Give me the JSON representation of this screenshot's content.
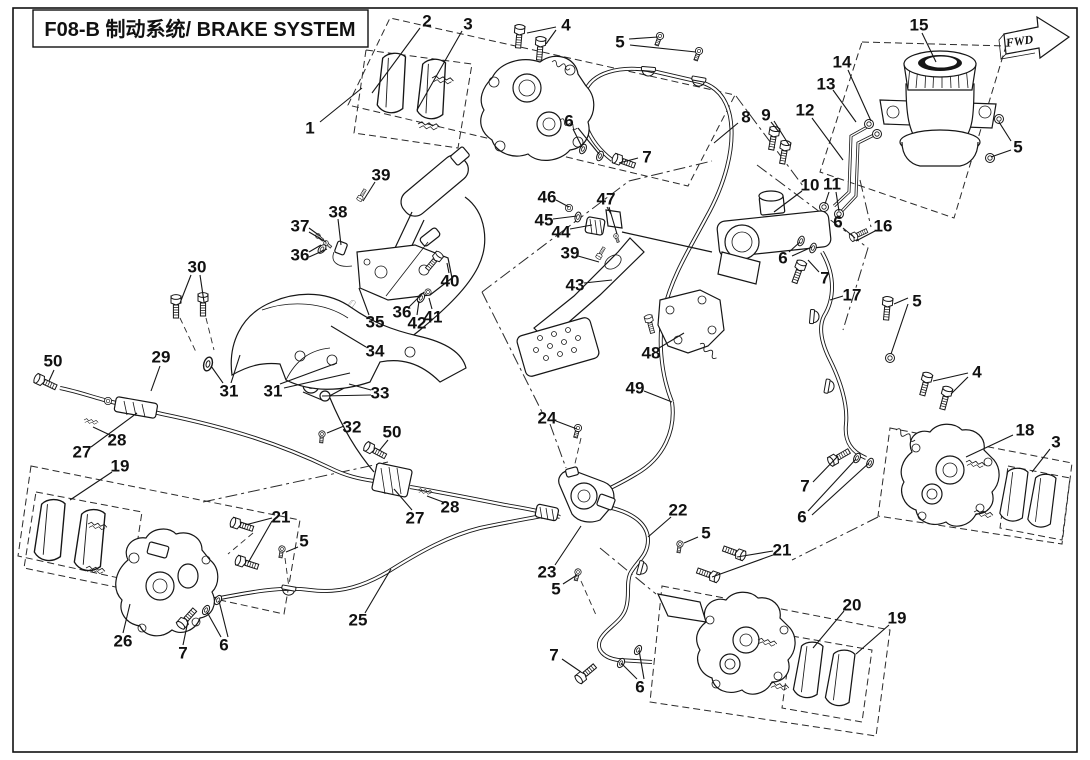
{
  "title": "F08-B 制动系统/ BRAKE SYSTEM",
  "fwd_label": "FWD",
  "callouts": [
    {
      "n": "1",
      "x": 310,
      "y": 128,
      "lines": [
        [
          320,
          122,
          362,
          88
        ]
      ]
    },
    {
      "n": "2",
      "x": 427,
      "y": 21,
      "lines": [
        [
          420,
          28,
          372,
          93
        ]
      ]
    },
    {
      "n": "3",
      "x": 468,
      "y": 24,
      "lines": [
        [
          462,
          31,
          417,
          110
        ]
      ]
    },
    {
      "n": "4",
      "x": 566,
      "y": 25,
      "lines": [
        [
          556,
          27,
          527,
          33
        ],
        [
          556,
          30,
          546,
          44
        ]
      ]
    },
    {
      "n": "5",
      "x": 620,
      "y": 42,
      "lines": [
        [
          629,
          39,
          658,
          37
        ],
        [
          630,
          45,
          696,
          52
        ]
      ]
    },
    {
      "n": "6",
      "x": 569,
      "y": 121,
      "lines": [
        [
          573,
          129,
          582,
          147
        ],
        [
          578,
          128,
          599,
          154
        ]
      ]
    },
    {
      "n": "7",
      "x": 647,
      "y": 157,
      "lines": [
        [
          638,
          158,
          619,
          163
        ]
      ]
    },
    {
      "n": "8",
      "x": 746,
      "y": 117,
      "lines": [
        [
          738,
          123,
          714,
          143
        ]
      ]
    },
    {
      "n": "9",
      "x": 766,
      "y": 115,
      "lines": [
        [
          771,
          122,
          779,
          132
        ],
        [
          774,
          121,
          789,
          145
        ]
      ]
    },
    {
      "n": "12",
      "x": 805,
      "y": 110,
      "lines": [
        [
          812,
          118,
          843,
          160
        ]
      ]
    },
    {
      "n": "13",
      "x": 826,
      "y": 84,
      "lines": [
        [
          833,
          90,
          856,
          122
        ]
      ]
    },
    {
      "n": "14",
      "x": 842,
      "y": 62,
      "lines": [
        [
          848,
          70,
          871,
          121
        ]
      ]
    },
    {
      "n": "15",
      "x": 919,
      "y": 25,
      "lines": [
        [
          922,
          33,
          936,
          62
        ]
      ]
    },
    {
      "n": "5",
      "x": 1018,
      "y": 147,
      "lines": [
        [
          1011,
          141,
          999,
          122
        ],
        [
          1011,
          150,
          991,
          157
        ]
      ]
    },
    {
      "n": "10",
      "x": 810,
      "y": 185,
      "lines": [
        [
          802,
          191,
          774,
          212
        ]
      ]
    },
    {
      "n": "11",
      "x": 832,
      "y": 184,
      "lines": [
        [
          829,
          192,
          825,
          204
        ],
        [
          836,
          192,
          839,
          211
        ]
      ]
    },
    {
      "n": "6",
      "x": 838,
      "y": 222,
      "lines": [
        [
          843,
          228,
          855,
          238
        ]
      ]
    },
    {
      "n": "16",
      "x": 883,
      "y": 226,
      "lines": [
        [
          875,
          231,
          856,
          241
        ]
      ]
    },
    {
      "n": "6",
      "x": 783,
      "y": 258,
      "lines": [
        [
          789,
          252,
          800,
          242
        ],
        [
          792,
          256,
          812,
          247
        ]
      ]
    },
    {
      "n": "7",
      "x": 825,
      "y": 278,
      "lines": [
        [
          819,
          272,
          808,
          260
        ]
      ]
    },
    {
      "n": "17",
      "x": 852,
      "y": 295,
      "lines": [
        [
          843,
          296,
          830,
          300
        ]
      ]
    },
    {
      "n": "5",
      "x": 917,
      "y": 301,
      "lines": [
        [
          908,
          298,
          894,
          304
        ],
        [
          908,
          304,
          891,
          354
        ]
      ]
    },
    {
      "n": "4",
      "x": 977,
      "y": 372,
      "lines": [
        [
          968,
          373,
          933,
          381
        ],
        [
          968,
          377,
          951,
          394
        ]
      ]
    },
    {
      "n": "18",
      "x": 1025,
      "y": 430,
      "lines": [
        [
          1013,
          435,
          966,
          457
        ]
      ]
    },
    {
      "n": "3",
      "x": 1056,
      "y": 442,
      "lines": [
        [
          1050,
          449,
          1032,
          472
        ]
      ]
    },
    {
      "n": "7",
      "x": 805,
      "y": 486,
      "lines": [
        [
          813,
          482,
          838,
          456
        ]
      ]
    },
    {
      "n": "6",
      "x": 802,
      "y": 517,
      "lines": [
        [
          808,
          511,
          856,
          459
        ],
        [
          812,
          515,
          869,
          463
        ]
      ]
    },
    {
      "n": "46",
      "x": 547,
      "y": 197,
      "lines": [
        [
          556,
          200,
          569,
          207
        ]
      ]
    },
    {
      "n": "45",
      "x": 544,
      "y": 220,
      "lines": [
        [
          553,
          219,
          577,
          216
        ]
      ]
    },
    {
      "n": "44",
      "x": 561,
      "y": 232,
      "lines": [
        [
          570,
          229,
          592,
          225
        ]
      ]
    },
    {
      "n": "47",
      "x": 606,
      "y": 199,
      "lines": [
        [
          607,
          207,
          611,
          214
        ],
        [
          609,
          207,
          617,
          234
        ]
      ]
    },
    {
      "n": "39",
      "x": 570,
      "y": 253,
      "lines": [
        [
          578,
          256,
          599,
          262
        ]
      ]
    },
    {
      "n": "43",
      "x": 575,
      "y": 285,
      "lines": [
        [
          584,
          283,
          612,
          280
        ]
      ]
    },
    {
      "n": "48",
      "x": 651,
      "y": 353,
      "lines": [
        [
          659,
          348,
          684,
          333
        ]
      ]
    },
    {
      "n": "49",
      "x": 635,
      "y": 388,
      "lines": [
        [
          644,
          391,
          672,
          402
        ]
      ]
    },
    {
      "n": "39",
      "x": 381,
      "y": 175,
      "lines": [
        [
          375,
          182,
          363,
          201
        ]
      ]
    },
    {
      "n": "38",
      "x": 338,
      "y": 212,
      "lines": [
        [
          338,
          219,
          341,
          245
        ]
      ]
    },
    {
      "n": "37",
      "x": 300,
      "y": 226,
      "lines": [
        [
          309,
          228,
          320,
          236
        ],
        [
          309,
          232,
          326,
          242
        ]
      ]
    },
    {
      "n": "36",
      "x": 300,
      "y": 255,
      "lines": [
        [
          309,
          252,
          321,
          245
        ],
        [
          309,
          257,
          327,
          249
        ]
      ]
    },
    {
      "n": "30",
      "x": 197,
      "y": 267,
      "lines": [
        [
          191,
          275,
          180,
          303
        ],
        [
          200,
          275,
          204,
          302
        ]
      ]
    },
    {
      "n": "40",
      "x": 450,
      "y": 281,
      "lines": [
        [
          449,
          273,
          447,
          263
        ]
      ]
    },
    {
      "n": "35",
      "x": 375,
      "y": 322,
      "lines": [
        [
          369,
          315,
          359,
          288
        ]
      ]
    },
    {
      "n": "36",
      "x": 402,
      "y": 312,
      "lines": [
        [
          409,
          307,
          424,
          292
        ]
      ]
    },
    {
      "n": "42",
      "x": 417,
      "y": 323,
      "lines": [
        [
          417,
          315,
          419,
          301
        ]
      ]
    },
    {
      "n": "41",
      "x": 433,
      "y": 317,
      "lines": [
        [
          432,
          309,
          429,
          298
        ]
      ]
    },
    {
      "n": "34",
      "x": 375,
      "y": 351,
      "lines": [
        [
          366,
          347,
          331,
          326
        ]
      ]
    },
    {
      "n": "29",
      "x": 161,
      "y": 357,
      "lines": [
        [
          160,
          366,
          151,
          391
        ]
      ]
    },
    {
      "n": "31",
      "x": 229,
      "y": 391,
      "lines": [
        [
          223,
          383,
          211,
          366
        ],
        [
          231,
          383,
          240,
          355
        ]
      ]
    },
    {
      "n": "31",
      "x": 273,
      "y": 391,
      "lines": [
        [
          280,
          384,
          337,
          363
        ],
        [
          284,
          388,
          350,
          373
        ]
      ]
    },
    {
      "n": "33",
      "x": 380,
      "y": 393,
      "lines": [
        [
          371,
          390,
          349,
          384
        ],
        [
          371,
          395,
          322,
          396
        ]
      ]
    },
    {
      "n": "32",
      "x": 352,
      "y": 427,
      "lines": [
        [
          344,
          426,
          327,
          433
        ]
      ]
    },
    {
      "n": "50",
      "x": 53,
      "y": 361,
      "lines": [
        [
          54,
          370,
          49,
          381
        ]
      ]
    },
    {
      "n": "27",
      "x": 82,
      "y": 452,
      "lines": [
        [
          91,
          447,
          137,
          413
        ]
      ]
    },
    {
      "n": "28",
      "x": 117,
      "y": 440,
      "lines": [
        [
          110,
          435,
          93,
          427
        ]
      ]
    },
    {
      "n": "19",
      "x": 120,
      "y": 466,
      "lines": [
        [
          112,
          472,
          70,
          500
        ]
      ]
    },
    {
      "n": "50",
      "x": 392,
      "y": 432,
      "lines": [
        [
          388,
          440,
          379,
          451
        ]
      ]
    },
    {
      "n": "27",
      "x": 415,
      "y": 518,
      "lines": [
        [
          412,
          510,
          394,
          489
        ]
      ]
    },
    {
      "n": "28",
      "x": 450,
      "y": 507,
      "lines": [
        [
          443,
          502,
          427,
          496
        ]
      ]
    },
    {
      "n": "24",
      "x": 547,
      "y": 418,
      "lines": [
        [
          556,
          421,
          577,
          429
        ]
      ]
    },
    {
      "n": "23",
      "x": 547,
      "y": 572,
      "lines": [
        [
          555,
          565,
          581,
          526
        ]
      ]
    },
    {
      "n": "5",
      "x": 556,
      "y": 589,
      "lines": [
        [
          563,
          584,
          577,
          575
        ]
      ]
    },
    {
      "n": "22",
      "x": 678,
      "y": 510,
      "lines": [
        [
          671,
          517,
          648,
          537
        ]
      ]
    },
    {
      "n": "5",
      "x": 706,
      "y": 533,
      "lines": [
        [
          698,
          537,
          684,
          543
        ]
      ]
    },
    {
      "n": "21",
      "x": 782,
      "y": 550,
      "lines": [
        [
          773,
          551,
          737,
          557
        ],
        [
          773,
          555,
          712,
          577
        ]
      ]
    },
    {
      "n": "21",
      "x": 281,
      "y": 517,
      "lines": [
        [
          272,
          518,
          245,
          525
        ],
        [
          272,
          521,
          248,
          563
        ]
      ]
    },
    {
      "n": "5",
      "x": 304,
      "y": 541,
      "lines": [
        [
          298,
          547,
          286,
          552
        ]
      ]
    },
    {
      "n": "26",
      "x": 123,
      "y": 641,
      "lines": [
        [
          123,
          633,
          130,
          604
        ]
      ]
    },
    {
      "n": "7",
      "x": 183,
      "y": 653,
      "lines": [
        [
          183,
          645,
          188,
          621
        ]
      ]
    },
    {
      "n": "6",
      "x": 224,
      "y": 645,
      "lines": [
        [
          221,
          637,
          207,
          612
        ],
        [
          228,
          637,
          219,
          601
        ]
      ]
    },
    {
      "n": "25",
      "x": 358,
      "y": 620,
      "lines": [
        [
          365,
          613,
          391,
          569
        ]
      ]
    },
    {
      "n": "7",
      "x": 554,
      "y": 655,
      "lines": [
        [
          562,
          659,
          581,
          672
        ]
      ]
    },
    {
      "n": "6",
      "x": 640,
      "y": 687,
      "lines": [
        [
          637,
          679,
          621,
          663
        ],
        [
          644,
          679,
          639,
          650
        ]
      ]
    },
    {
      "n": "20",
      "x": 852,
      "y": 605,
      "lines": [
        [
          844,
          611,
          813,
          648
        ]
      ]
    },
    {
      "n": "19",
      "x": 897,
      "y": 618,
      "lines": [
        [
          889,
          625,
          856,
          654
        ]
      ]
    }
  ]
}
